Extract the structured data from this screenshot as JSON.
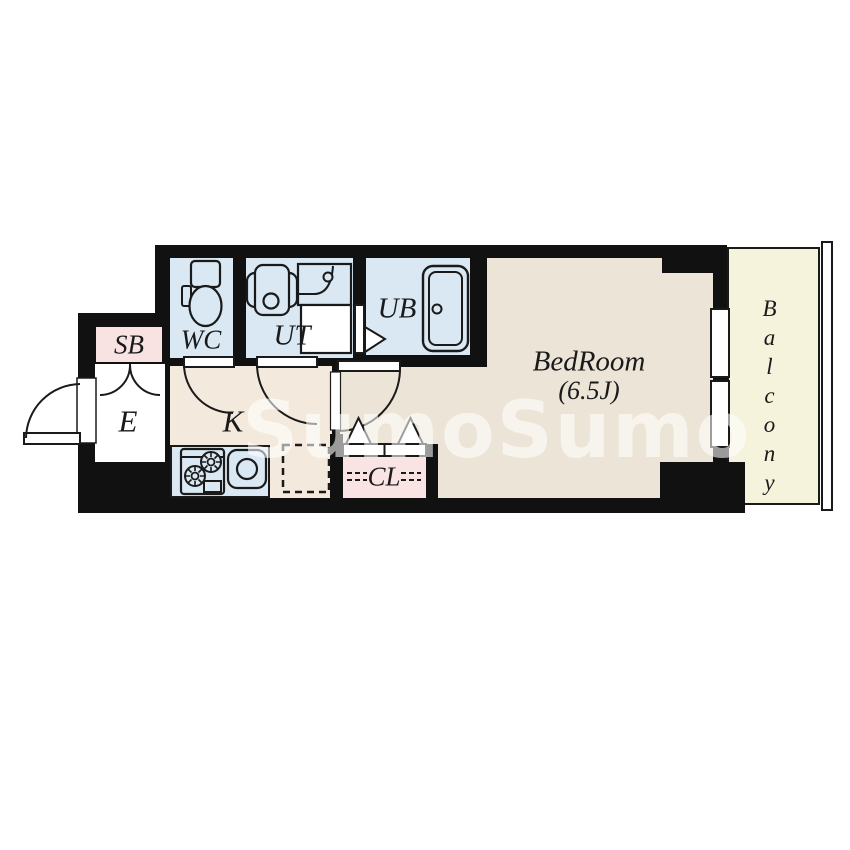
{
  "floorplan": {
    "palette": {
      "wall": "#111111",
      "line": "#1a1a1a",
      "white": "#ffffff",
      "watermark_color": "rgba(255,255,255,0.58)"
    },
    "rooms": {
      "shoe_box": {
        "label": "SB",
        "color": "#f8e2e2"
      },
      "toilet_room": {
        "label": "WC",
        "color": "#d9e8f2"
      },
      "utility": {
        "label": "UT",
        "color": "#d9e8f2"
      },
      "unit_bath": {
        "label": "UB",
        "color": "#d9e8f2"
      },
      "entrance": {
        "label": "E",
        "color": "#ffffff"
      },
      "kitchen": {
        "label": "K",
        "color": "#f3e9dc",
        "counter_color": "#d9e8f2"
      },
      "closet": {
        "label": "CL",
        "color": "#f9e3e3"
      },
      "bedroom": {
        "label": "BedRoom",
        "size": "(6.5J)",
        "color": "#ece4d7"
      },
      "balcony": {
        "label": "Balcony",
        "color": "#f6f3dd"
      }
    },
    "watermark": "SumoSumo",
    "fixtures": [
      "toilet-icon",
      "washer-pan-icon",
      "vanity-sink-icon",
      "bathtub-icon",
      "gas-stove-icon",
      "kitchen-sink-icon",
      "refrigerator-space",
      "bifold-closet-doors",
      "swing-door",
      "entrance-door",
      "window",
      "balcony-railing"
    ]
  }
}
